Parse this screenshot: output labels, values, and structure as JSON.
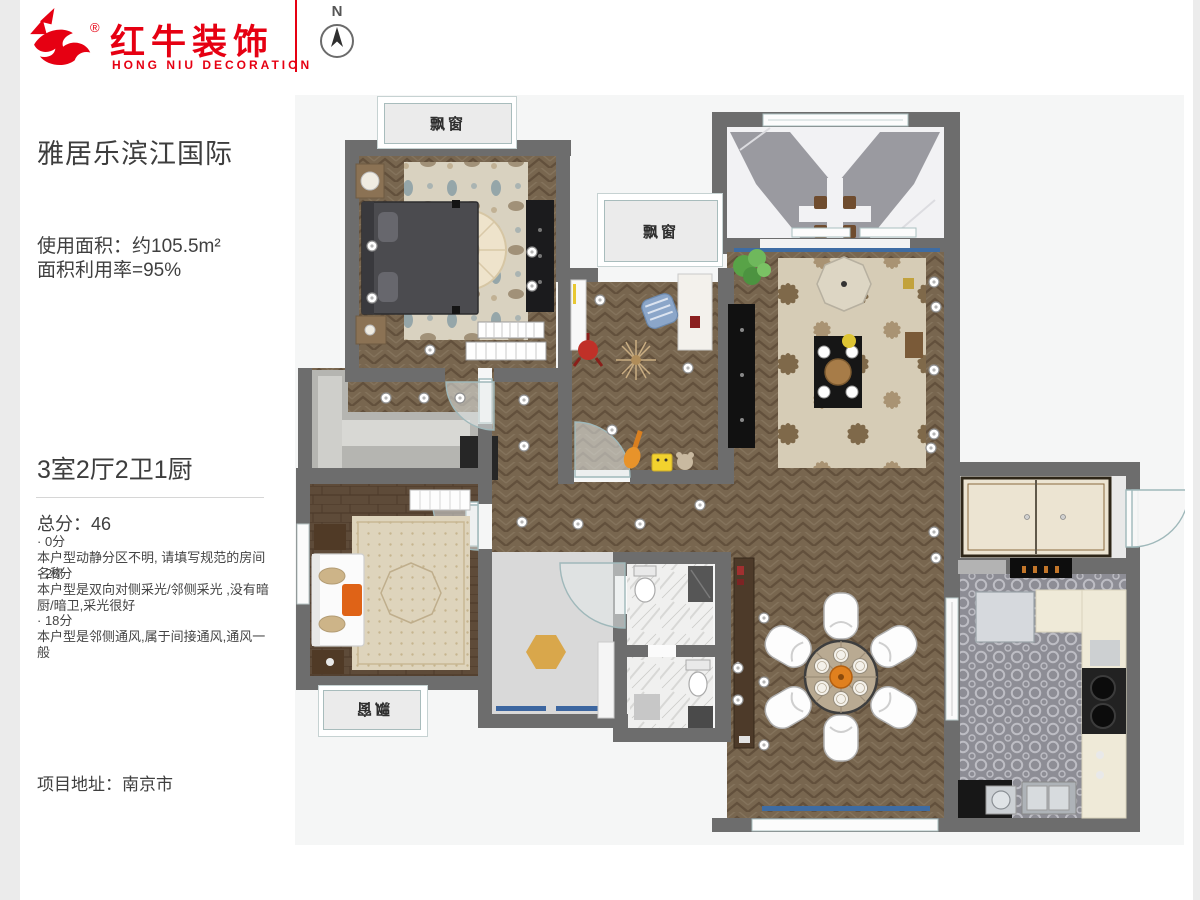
{
  "brand": {
    "name_cn": "红牛装饰",
    "name_en": "HONG NIU DECORATION",
    "registered_mark": "®",
    "accent_color": "#e60012"
  },
  "compass": {
    "north_label": "N"
  },
  "sidebar": {
    "project_name": "雅居乐滨江国际",
    "area_line1": "使用面积：约105.5m²",
    "area_line2": "面积利用率=95%",
    "rooms_summary": "3室2厅2卫1厨",
    "total_score": "总分：46",
    "score_items": [
      {
        "score": "· 0分",
        "desc": "本户型动静分区不明, 请填写规范的房间名称"
      },
      {
        "score": "· 28分",
        "desc": "本户型是双向对侧采光/邻侧采光 ,没有暗厨/暗卫,采光很好"
      },
      {
        "score": "· 18分",
        "desc": "本户型是邻侧通风,属于间接通风,通风一般"
      }
    ],
    "address": "项目地址：南京市"
  },
  "floorplan": {
    "bay_window_labels": [
      "飘窗",
      "飘窗",
      "飘窗"
    ],
    "colors": {
      "wall": "#6d6d6d",
      "wood_floor": "#78664f",
      "plank_floor": "#5d4a38",
      "kitchen_tile": "#8d8d95",
      "rug_cream": "#d6ccb6",
      "window_blue": "#3e6ca3",
      "table_orange": "#e0801e"
    }
  }
}
